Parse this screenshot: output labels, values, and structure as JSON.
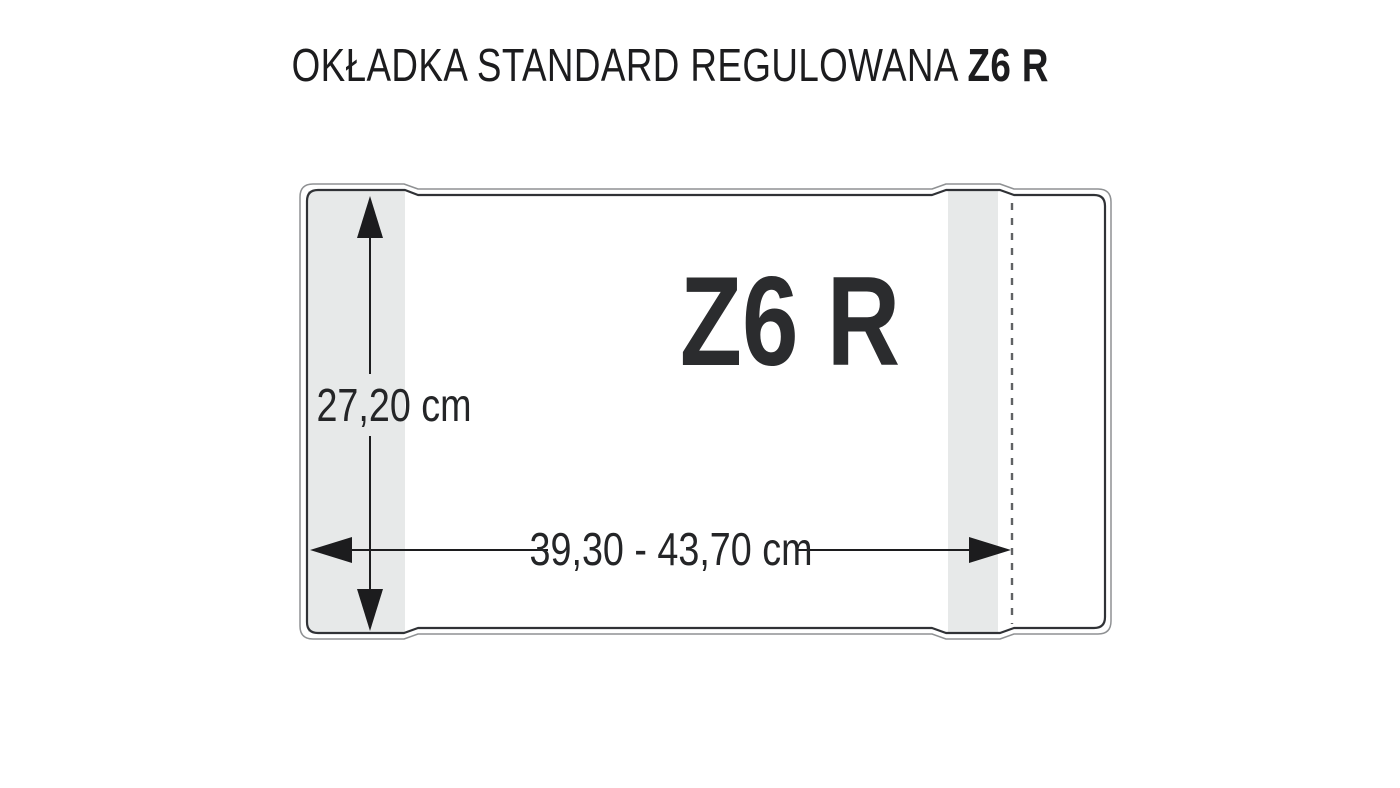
{
  "title": {
    "prefix": "OKŁADKA STANDARD REGULOWANA",
    "model": "Z6 R"
  },
  "diagram": {
    "model_label": "Z6 R",
    "height_label": "27,20 cm",
    "width_label": "39,30 - 43,70 cm",
    "colors": {
      "outline_dark": "#303236",
      "outline_shadow": "#8f9193",
      "flap_fill": "#e7e9e9",
      "fold_dash": "#606264",
      "arrow": "#1c1c1e",
      "label_text": "#242527",
      "model_text": "#2b2c2e",
      "title_text": "#1c1c1e",
      "page_bg": "#ffffff"
    }
  }
}
